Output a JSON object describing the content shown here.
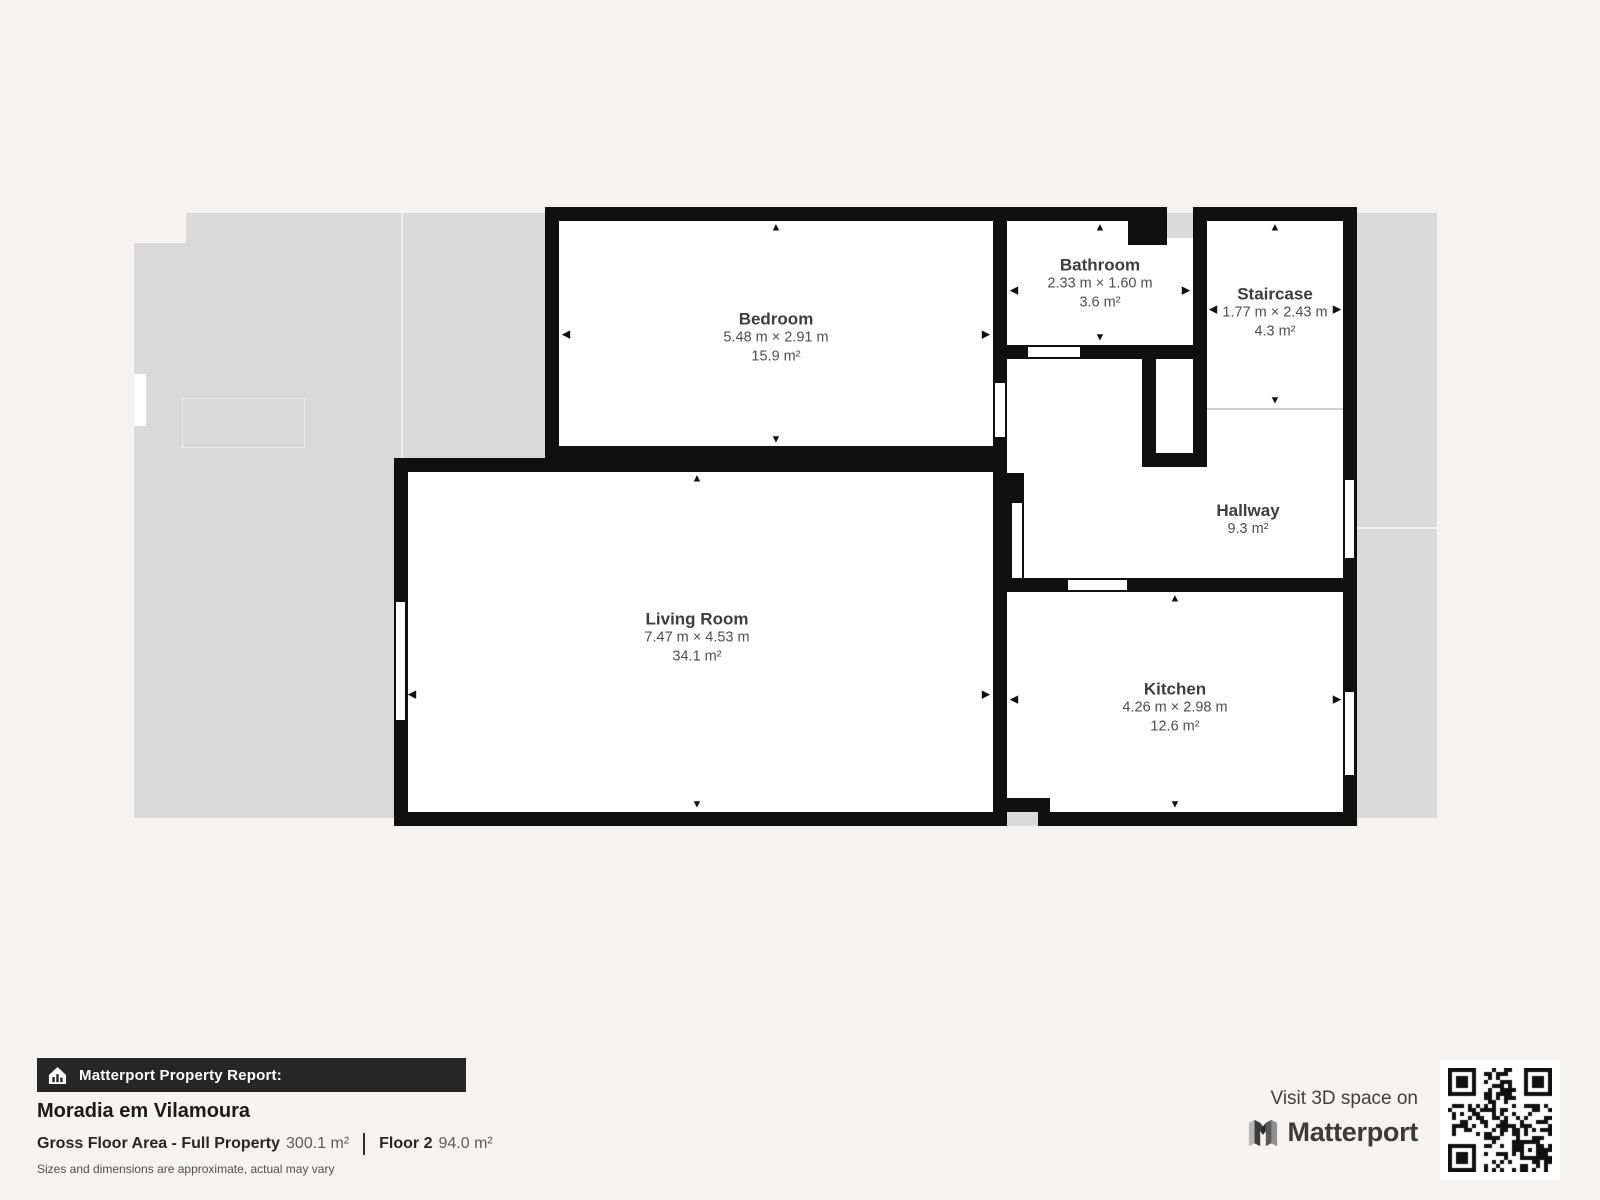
{
  "icons": {
    "up": "▲",
    "down": "▼",
    "left": "◀",
    "right": "▶"
  },
  "plan": {
    "rooms": [
      {
        "id": "bedroom",
        "name": "Bedroom",
        "dimensions": "5.48 m × 2.91 m",
        "area": "15.9 m²"
      },
      {
        "id": "bathroom",
        "name": "Bathroom",
        "dimensions": "2.33 m × 1.60 m",
        "area": "3.6 m²"
      },
      {
        "id": "staircase",
        "name": "Staircase",
        "dimensions": "1.77 m × 2.43 m",
        "area": "4.3 m²"
      },
      {
        "id": "hallway",
        "name": "Hallway",
        "area": "9.3 m²"
      },
      {
        "id": "living-room",
        "name": "Living Room",
        "dimensions": "7.47 m × 4.53 m",
        "area": "34.1 m²"
      },
      {
        "id": "kitchen",
        "name": "Kitchen",
        "dimensions": "4.26 m × 2.98 m",
        "area": "12.6 m²"
      }
    ]
  },
  "footer": {
    "report_label": "Matterport Property Report:",
    "property_name": "Moradia em Vilamoura",
    "gfa_label": "Gross Floor Area - Full Property",
    "gfa_value": "300.1 m²",
    "floor_label": "Floor 2",
    "floor_value": "94.0 m²",
    "disclaimer": "Sizes and dimensions are approximate, actual may vary",
    "visit_text": "Visit 3D space on",
    "brand": "Matterport"
  },
  "colors": {
    "bg": "#f4f3f1",
    "terrace": "#d9d9d9",
    "wall": "#101010",
    "room": "#ffffff",
    "bar-bg": "#262626",
    "text-dark": "#1a1a1a",
    "text-room": "#3d3d3d",
    "text-dim": "#4e4e4e",
    "text-muted": "#4f4f4f"
  }
}
